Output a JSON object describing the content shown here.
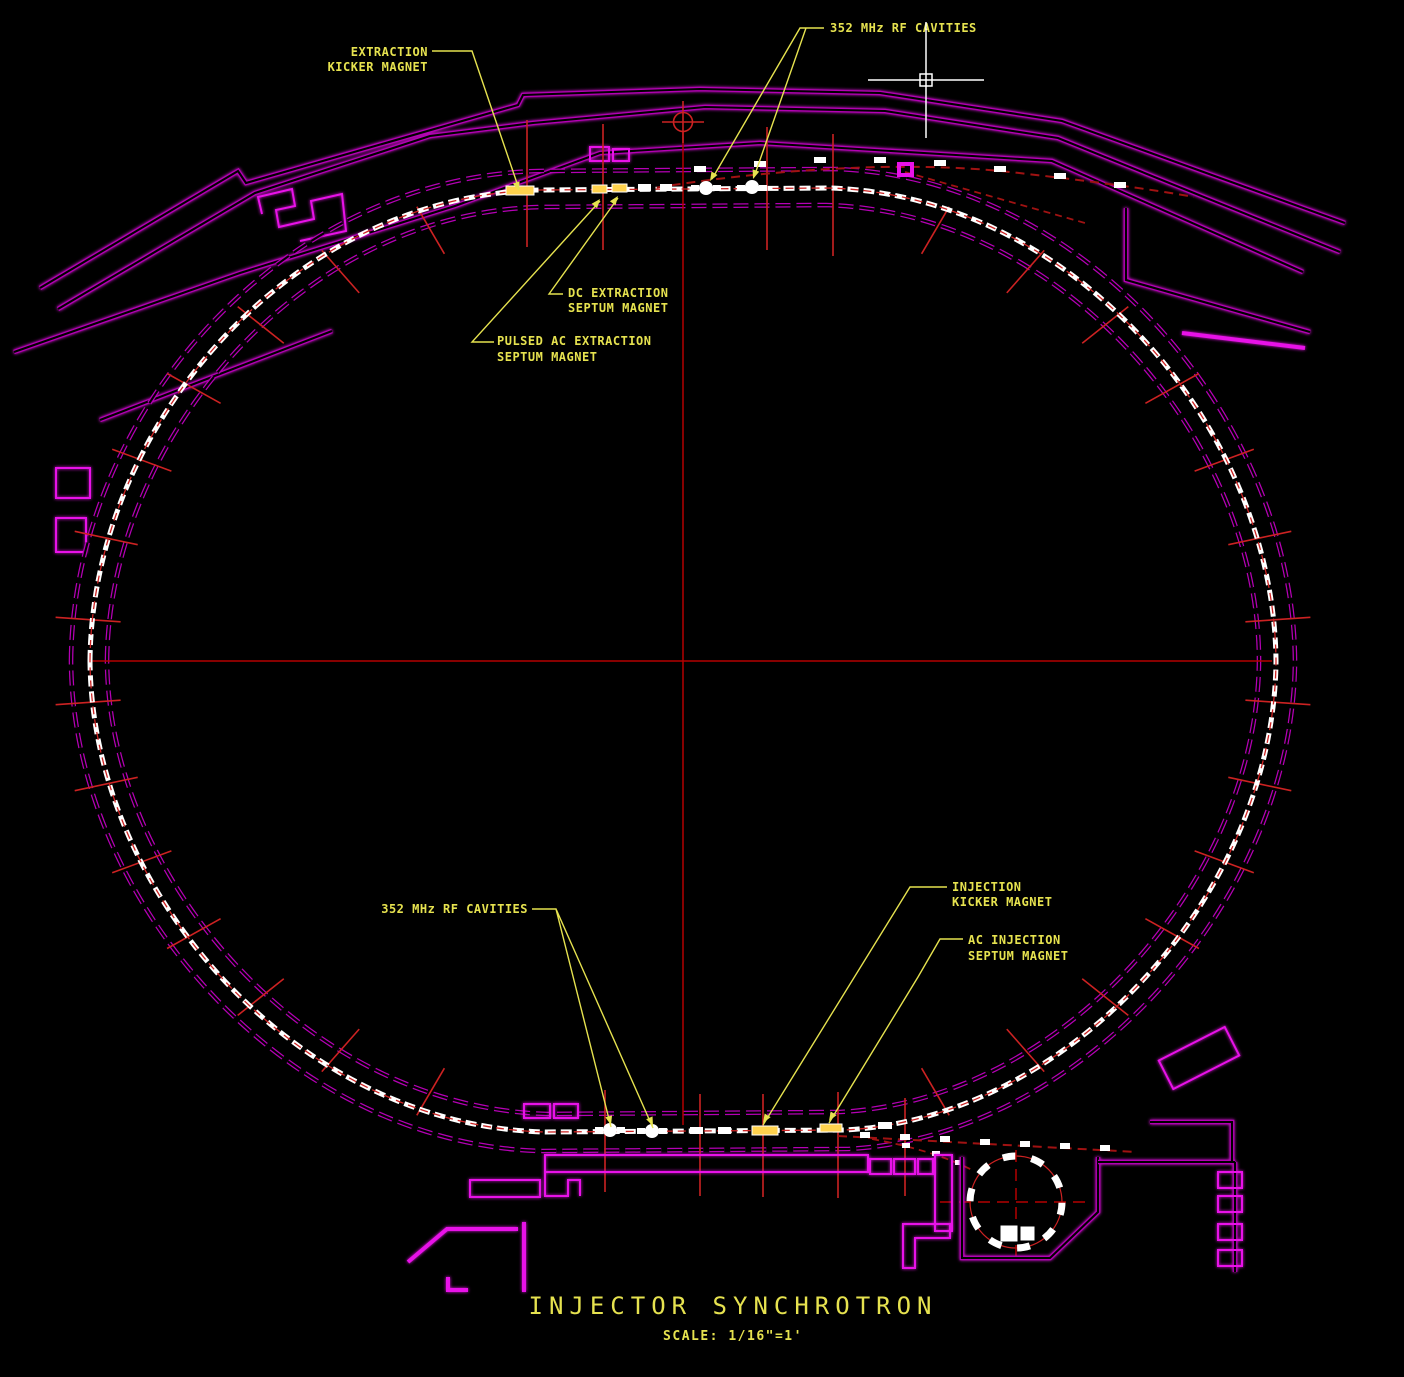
{
  "drawing": {
    "title": "INJECTOR  SYNCHROTRON",
    "scale_note": "SCALE: 1/16\"=1'"
  },
  "callouts": {
    "extraction_kicker": [
      "EXTRACTION",
      "KICKER MAGNET"
    ],
    "rf_cavities_top": "352 MHz RF CAVITIES",
    "dc_extraction_septum": [
      "DC EXTRACTION",
      "SEPTUM MAGNET"
    ],
    "pulsed_ac_extraction_septum": [
      "PULSED AC EXTRACTION",
      "SEPTUM MAGNET"
    ],
    "rf_cavities_bottom": "352 MHz RF CAVITIES",
    "injection_kicker": [
      "INJECTION",
      "KICKER MAGNET"
    ],
    "ac_injection_septum": [
      "AC INJECTION",
      "SEPTUM MAGNET"
    ]
  },
  "colors": {
    "background": "#000000",
    "wall_magenta": "#b400b4",
    "wall_bright": "#e812e8",
    "beam_chain_white": "#ffffff",
    "centerline_red": "#b40000",
    "tick_red": "#cc2222",
    "beamline_red": "#a01212",
    "callout_yellow": "#e6e24f",
    "highlight_yellow": "#ffd24d",
    "cursor_white": "#ffffff"
  }
}
